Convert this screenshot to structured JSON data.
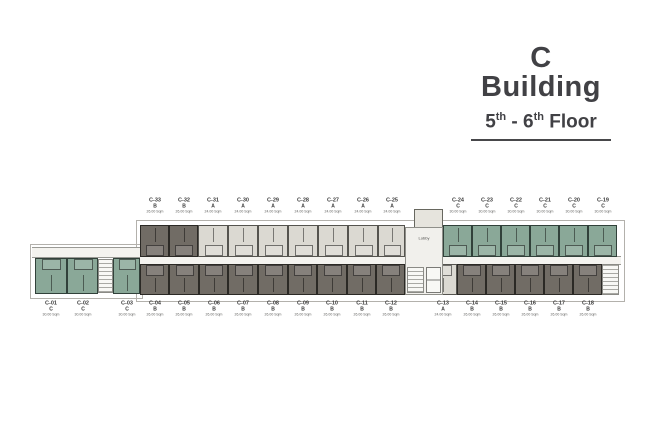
{
  "header": {
    "title": "C Building",
    "floor": {
      "n1": "5",
      "sup1": "th",
      "sep": " - ",
      "n2": "6",
      "sup2": "th",
      "rest": " Floor"
    }
  },
  "plan": {
    "lobby_label": "Lobby",
    "colors": {
      "type_a_fill": "#dbd9d2",
      "type_b_fill": "#716c65",
      "type_c_fill": "#8aa898",
      "corridor": "#f4f3ef",
      "title_text": "#414145"
    },
    "units_top": [
      {
        "id": "C-33",
        "type": "B",
        "area": "26.00 Sqm"
      },
      {
        "id": "C-32",
        "type": "B",
        "area": "26.00 Sqm"
      },
      {
        "id": "C-31",
        "type": "A",
        "area": "24.00 Sqm"
      },
      {
        "id": "C-30",
        "type": "A",
        "area": "24.00 Sqm"
      },
      {
        "id": "C-29",
        "type": "A",
        "area": "24.00 Sqm"
      },
      {
        "id": "C-28",
        "type": "A",
        "area": "24.00 Sqm"
      },
      {
        "id": "C-27",
        "type": "A",
        "area": "24.00 Sqm"
      },
      {
        "id": "C-26",
        "type": "A",
        "area": "24.00 Sqm"
      },
      {
        "id": "C-25",
        "type": "A",
        "area": "24.00 Sqm"
      },
      {
        "id": "C-24",
        "type": "C",
        "area": "30.00 Sqm"
      },
      {
        "id": "C-23",
        "type": "C",
        "area": "30.00 Sqm"
      },
      {
        "id": "C-22",
        "type": "C",
        "area": "30.00 Sqm"
      },
      {
        "id": "C-21",
        "type": "C",
        "area": "30.00 Sqm"
      },
      {
        "id": "C-20",
        "type": "C",
        "area": "30.00 Sqm"
      },
      {
        "id": "C-19",
        "type": "C",
        "area": "30.00 Sqm"
      }
    ],
    "units_bottom": [
      {
        "id": "C-01",
        "type": "C",
        "area": "30.00 Sqm"
      },
      {
        "id": "C-02",
        "type": "C",
        "area": "30.00 Sqm"
      },
      {
        "id": "C-03",
        "type": "C",
        "area": "30.00 Sqm"
      },
      {
        "id": "C-04",
        "type": "B",
        "area": "26.00 Sqm"
      },
      {
        "id": "C-05",
        "type": "B",
        "area": "26.00 Sqm"
      },
      {
        "id": "C-06",
        "type": "B",
        "area": "26.00 Sqm"
      },
      {
        "id": "C-07",
        "type": "B",
        "area": "26.00 Sqm"
      },
      {
        "id": "C-08",
        "type": "B",
        "area": "26.00 Sqm"
      },
      {
        "id": "C-09",
        "type": "B",
        "area": "26.00 Sqm"
      },
      {
        "id": "C-10",
        "type": "B",
        "area": "26.00 Sqm"
      },
      {
        "id": "C-11",
        "type": "B",
        "area": "26.00 Sqm"
      },
      {
        "id": "C-12",
        "type": "B",
        "area": "26.00 Sqm"
      },
      {
        "id": "C-13",
        "type": "A",
        "area": "24.00 Sqm"
      },
      {
        "id": "C-14",
        "type": "B",
        "area": "26.00 Sqm"
      },
      {
        "id": "C-15",
        "type": "B",
        "area": "26.00 Sqm"
      },
      {
        "id": "C-16",
        "type": "B",
        "area": "26.00 Sqm"
      },
      {
        "id": "C-17",
        "type": "B",
        "area": "26.00 Sqm"
      },
      {
        "id": "C-18",
        "type": "B",
        "area": "26.00 Sqm"
      }
    ]
  }
}
